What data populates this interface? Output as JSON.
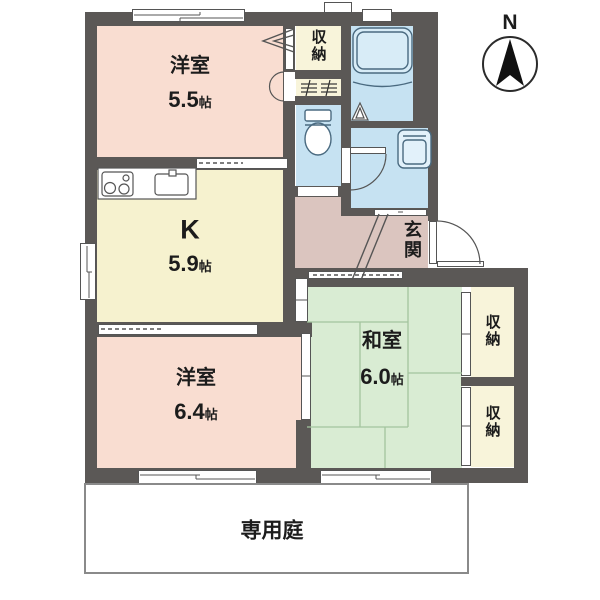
{
  "palette": {
    "wall": "#5b5856",
    "western_room": "#f9ddd1",
    "kitchen": "#f6f2cf",
    "japanese_room": "#d9ecd3",
    "water_area": "#c6e2f2",
    "closet": "#f8f4da",
    "entrance": "#dbc5bf",
    "tatami_line": "#a3c49e",
    "outline": "#555555",
    "garden_border": "#8a8a8a",
    "text": "#1c1c1c"
  },
  "compass": {
    "label": "N"
  },
  "rooms": {
    "western_a": {
      "name": "洋室",
      "size_value": "5.5",
      "size_unit": "帖"
    },
    "kitchen": {
      "name": "K",
      "size_value": "5.9",
      "size_unit": "帖"
    },
    "western_b": {
      "name": "洋室",
      "size_value": "6.4",
      "size_unit": "帖"
    },
    "japanese": {
      "name": "和室",
      "size_value": "6.0",
      "size_unit": "帖"
    },
    "entrance": {
      "name": "玄関"
    },
    "closet_top": {
      "name": "収納"
    },
    "closet_right_upper": {
      "name": "収納"
    },
    "closet_right_lower": {
      "name": "収納"
    },
    "garden": {
      "name": "専用庭"
    }
  }
}
